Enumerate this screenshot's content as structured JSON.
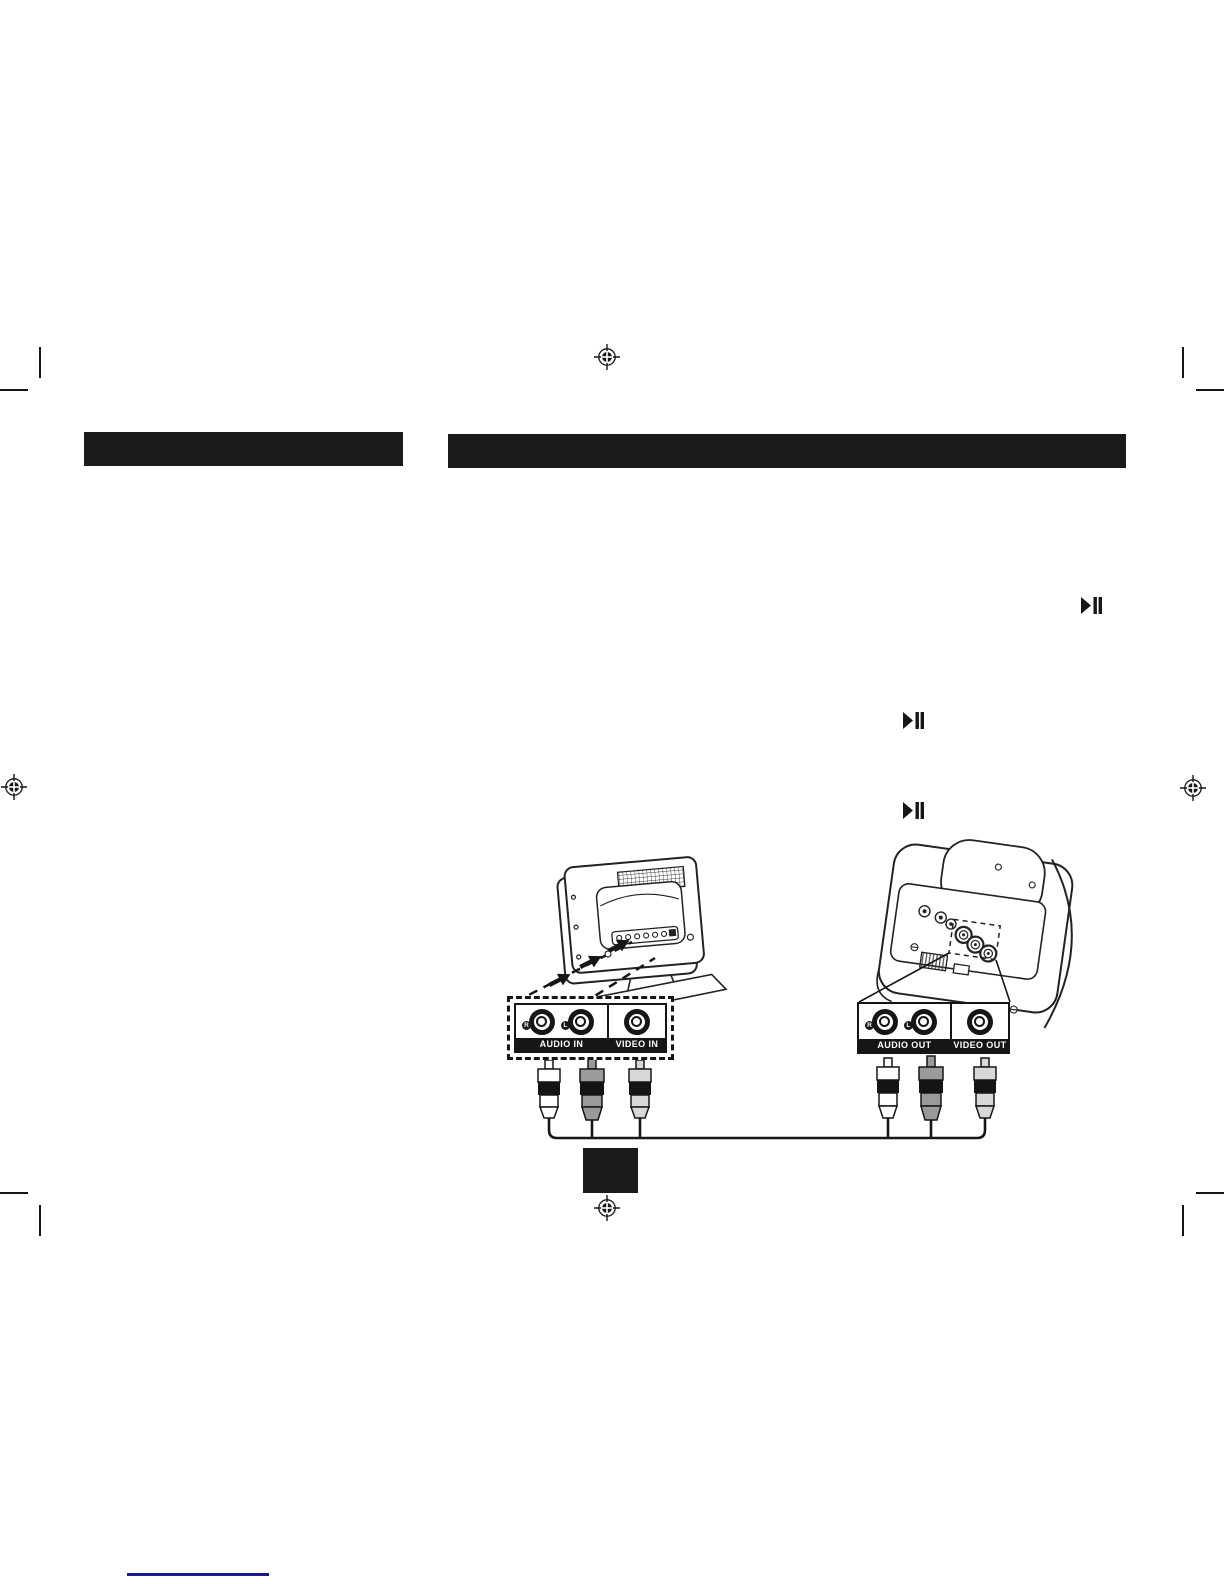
{
  "colors": {
    "ink": "#161616",
    "header_bar": "#1d1a1a",
    "plug_white": "#ffffff",
    "plug_gray": "#9a9a9a",
    "plug_light_gray": "#d8d8d8",
    "plug_band": "#141414",
    "redacted_box": "#1c1a1a",
    "footer_line": "#1b1b8e",
    "page_background": "#ffffff"
  },
  "icons": {
    "play_pause": "play-pause-icon",
    "registration_mark": "registration-crosshair-icon",
    "crop_mark": "crop-mark-line"
  },
  "diagram": {
    "tv_panel": {
      "audio_label": "AUDIO IN",
      "video_label": "VIDEO IN",
      "right_jack_label": "R",
      "left_jack_label": "L"
    },
    "device_panel": {
      "audio_label": "AUDIO OUT",
      "video_label": "VIDEO OUT",
      "right_jack_label": "R",
      "left_jack_label": "L"
    }
  }
}
